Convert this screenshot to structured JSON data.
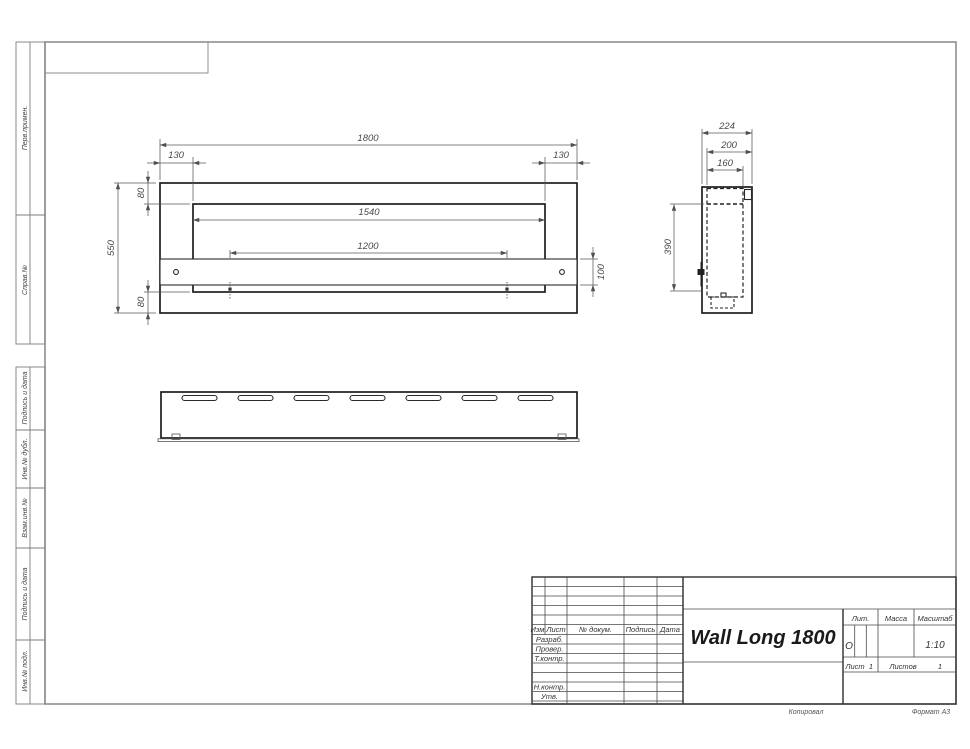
{
  "margin_columns": {
    "labels": [
      "Перв.примен.",
      "Справ.№",
      "Подпись и дата",
      "Инв.№ дубл.",
      "Взам.инв.№",
      "Подпись и дата",
      "Инв.№ подл."
    ]
  },
  "front_view": {
    "overall_width": "1800",
    "offset_left": "130",
    "offset_right": "130",
    "opening_width": "1540",
    "burner_span": "1200",
    "overall_height": "550",
    "top_flange": "80",
    "bottom_flange": "80",
    "shelf_height": "100"
  },
  "side_view": {
    "overall_depth": "224",
    "inner_depth": "200",
    "box_depth": "160",
    "inner_height": "390"
  },
  "title_block": {
    "title": "Wall Long 1800",
    "columns": {
      "izm": "Изм.",
      "list": "Лист",
      "doc": "№ докум.",
      "sign": "Подпись",
      "date": "Дата"
    },
    "rows": {
      "razrab": "Разраб.",
      "prover": "Провер.",
      "tkontr": "Т.контр.",
      "nkontr": "Н.контр.",
      "utv": "Утв."
    },
    "lit_label": "Лит.",
    "lit_value": "О",
    "mass_label": "Масса",
    "scale_label": "Масштаб",
    "scale_value": "1:10",
    "sheet_label": "Лист",
    "sheet_value": "1",
    "sheets_label": "Листов",
    "sheets_value": "1"
  },
  "footer": {
    "copied": "Копировал",
    "format": "Формат А3"
  }
}
